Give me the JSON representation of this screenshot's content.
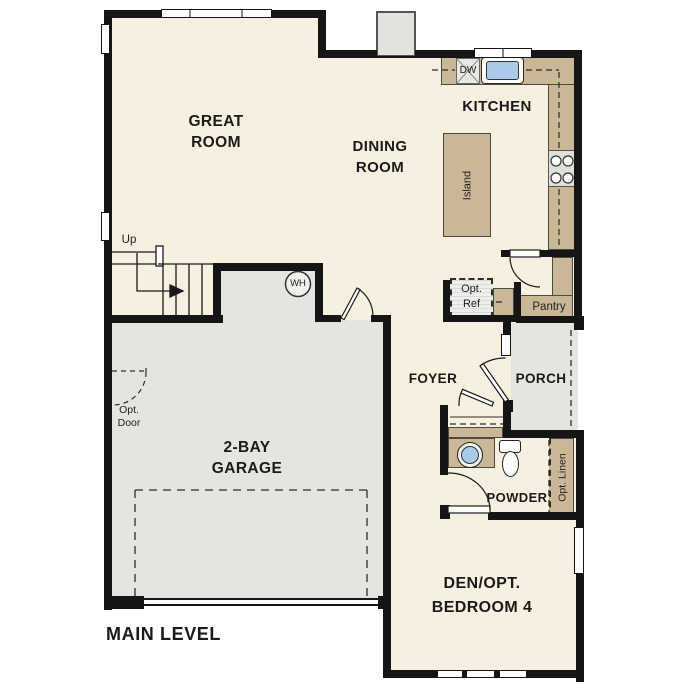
{
  "plan_title": "MAIN LEVEL",
  "colors": {
    "floor": "#f7efdf",
    "garage_porch_floor": "#e5e4e0",
    "counter_tan": "#c9b795",
    "sink_blue": "#a9cae9",
    "wall": "#151515"
  },
  "rooms": {
    "great_room": "GREAT\nROOM",
    "dining_room": "DINING\nROOM",
    "kitchen": "KITCHEN",
    "garage": "2-BAY\nGARAGE",
    "foyer": "FOYER",
    "porch": "PORCH",
    "powder": "POWDER",
    "den": "DEN/OPT.\nBEDROOM 4",
    "pantry": "Pantry"
  },
  "fixtures": {
    "island": "Island",
    "dishwasher": "DW",
    "water_heater": "WH",
    "opt_ref": "Opt.\nRef",
    "opt_linen": "Opt. Linen",
    "opt_door": "Opt.\nDoor",
    "stairs_up": "Up"
  }
}
